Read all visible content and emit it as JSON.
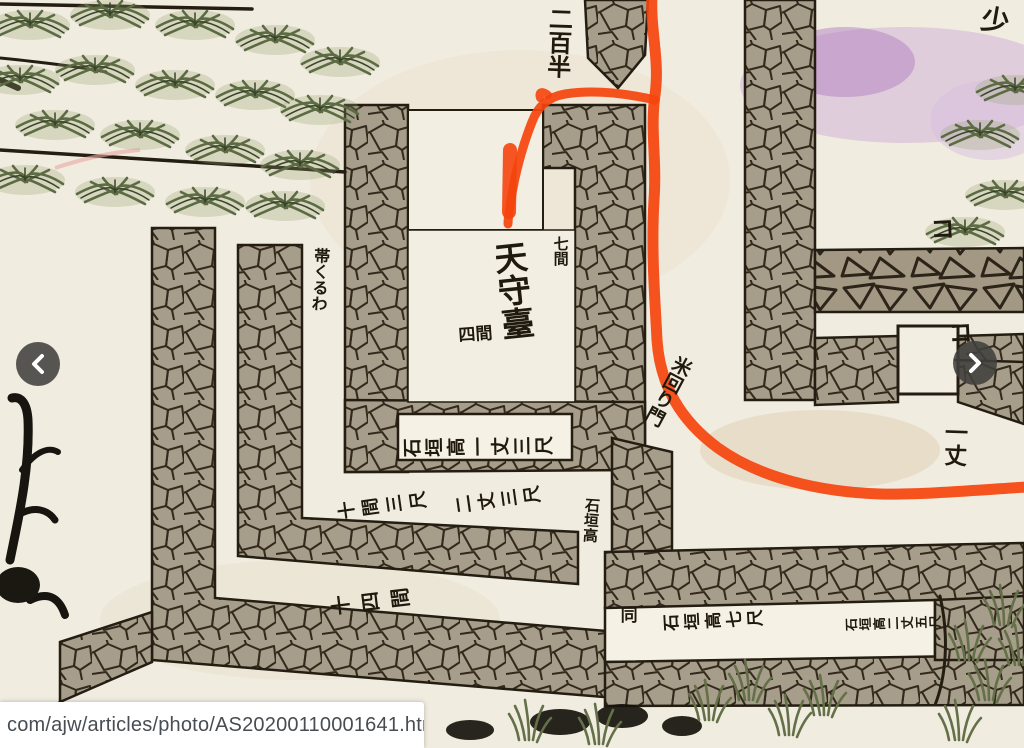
{
  "page": {
    "status_url": "com/ajw/articles/photo/AS20200110001641.html"
  },
  "carousel": {
    "prev_label": "previous photo",
    "prev_icon": "chevron-left-icon",
    "next_label": "next photo",
    "next_icon": "chevron-right-icon"
  },
  "colors": {
    "paper": "#f1ece0",
    "stone_fill": "#a79d8b",
    "ink": "#241e12",
    "route_red": "#f5440d",
    "foliage_green": "#5c6b44",
    "purple_tint": "#c5a0d0",
    "arrow_bg": "#40403c",
    "status_text": "#474d52"
  },
  "map": {
    "labels": [
      {
        "id": "distance-top",
        "text": "二百半",
        "x": 546,
        "y": 6,
        "size": 24,
        "mode": "vertical",
        "rot": 2
      },
      {
        "id": "keep-name",
        "text": "天守臺",
        "x": 489,
        "y": 243,
        "size": 33,
        "mode": "vertical",
        "rot": -6
      },
      {
        "id": "keep-width",
        "text": "七間",
        "x": 552,
        "y": 236,
        "size": 15,
        "mode": "vertical",
        "rot": 0
      },
      {
        "id": "keep-depth",
        "text": "四間",
        "x": 458,
        "y": 328,
        "size": 17,
        "mode": "horizontal",
        "rot": -4
      },
      {
        "id": "corridor-name",
        "text": "帯くるわ",
        "x": 312,
        "y": 247,
        "size": 16,
        "mode": "vertical",
        "rot": 3
      },
      {
        "id": "wall-height-keep",
        "text": "石垣高一丈三尺",
        "x": 404,
        "y": 438,
        "size": 19,
        "mode": "sideways",
        "rot": -1,
        "gap": 3
      },
      {
        "id": "span-mid-left",
        "text": "十間三尺",
        "x": 338,
        "y": 502,
        "size": 18,
        "mode": "sideways",
        "rot": -8,
        "gap": 6
      },
      {
        "id": "wall-height-mid",
        "text": "二丈三尺",
        "x": 455,
        "y": 496,
        "size": 18,
        "mode": "sideways",
        "rot": -8,
        "gap": 5
      },
      {
        "id": "wall-height-mid-2",
        "text": "石垣高",
        "x": 584,
        "y": 497,
        "size": 15,
        "mode": "vertical",
        "rot": 4
      },
      {
        "id": "span-outer",
        "text": "十四間",
        "x": 330,
        "y": 596,
        "size": 20,
        "mode": "sideways",
        "rot": -7,
        "gap": 10
      },
      {
        "id": "ditto-mark",
        "text": "同",
        "x": 617,
        "y": 606,
        "size": 17,
        "mode": "vertical",
        "rot": 0
      },
      {
        "id": "wall-height-se-1",
        "text": "石垣高七尺",
        "x": 664,
        "y": 614,
        "size": 17,
        "mode": "sideways",
        "rot": -3,
        "gap": 4
      },
      {
        "id": "wall-height-se-2",
        "text": "石垣高二丈五尺",
        "x": 846,
        "y": 618,
        "size": 13,
        "mode": "sideways",
        "rot": -2,
        "gap": 1
      },
      {
        "id": "route-note",
        "text": "米回り門",
        "x": 676,
        "y": 352,
        "size": 19,
        "mode": "vertical",
        "rot": 28
      },
      {
        "id": "height-right",
        "text": "一丈",
        "x": 942,
        "y": 420,
        "size": 23,
        "mode": "vertical",
        "rot": 2
      },
      {
        "id": "corner-char",
        "text": "少",
        "x": 984,
        "y": 4,
        "size": 28,
        "mode": "horizontal",
        "rot": 10
      },
      {
        "id": "gate-mark-upper",
        "text": "コ",
        "x": 930,
        "y": 218,
        "size": 24,
        "mode": "horizontal",
        "rot": -3
      },
      {
        "id": "gate-mark-lower",
        "text": "コ",
        "x": 948,
        "y": 322,
        "size": 24,
        "mode": "horizontal",
        "rot": -3
      }
    ]
  }
}
